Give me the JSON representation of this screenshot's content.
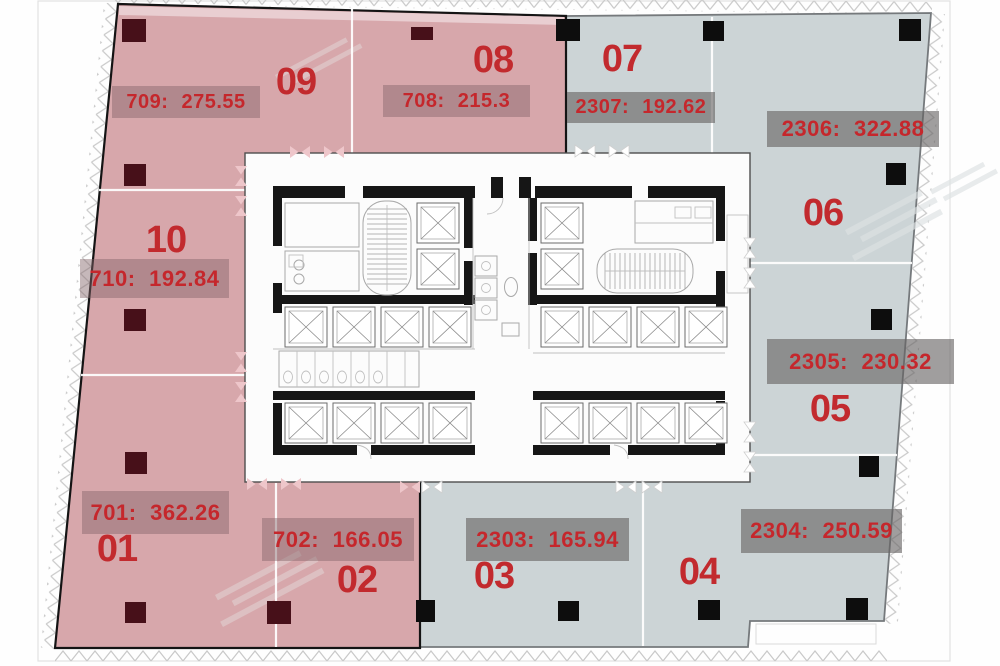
{
  "units": [
    {
      "id": "09",
      "area_label": "709: 275.55"
    },
    {
      "id": "08",
      "area_label": "708: 215.3"
    },
    {
      "id": "07",
      "area_label": "2307: 192.62"
    },
    {
      "id": "06",
      "area_label": "2306: 322.88"
    },
    {
      "id": "10",
      "area_label": "710: 192.84"
    },
    {
      "id": "05",
      "area_label": "2305: 230.32"
    },
    {
      "id": "01",
      "area_label": "701: 362.26"
    },
    {
      "id": "02",
      "area_label": "702: 166.05"
    },
    {
      "id": "03",
      "area_label": "2303: 165.94"
    },
    {
      "id": "04",
      "area_label": "2304: 250.59"
    }
  ],
  "colors": {
    "zone_pink": "#d7a7ab",
    "zone_blue": "#ccd4d6",
    "unit_number_red": "#c22a2e",
    "area_label_text_red": "#c5272c",
    "column_marker_maroon": "#471019",
    "column_marker_black": "#0d0d0d"
  }
}
